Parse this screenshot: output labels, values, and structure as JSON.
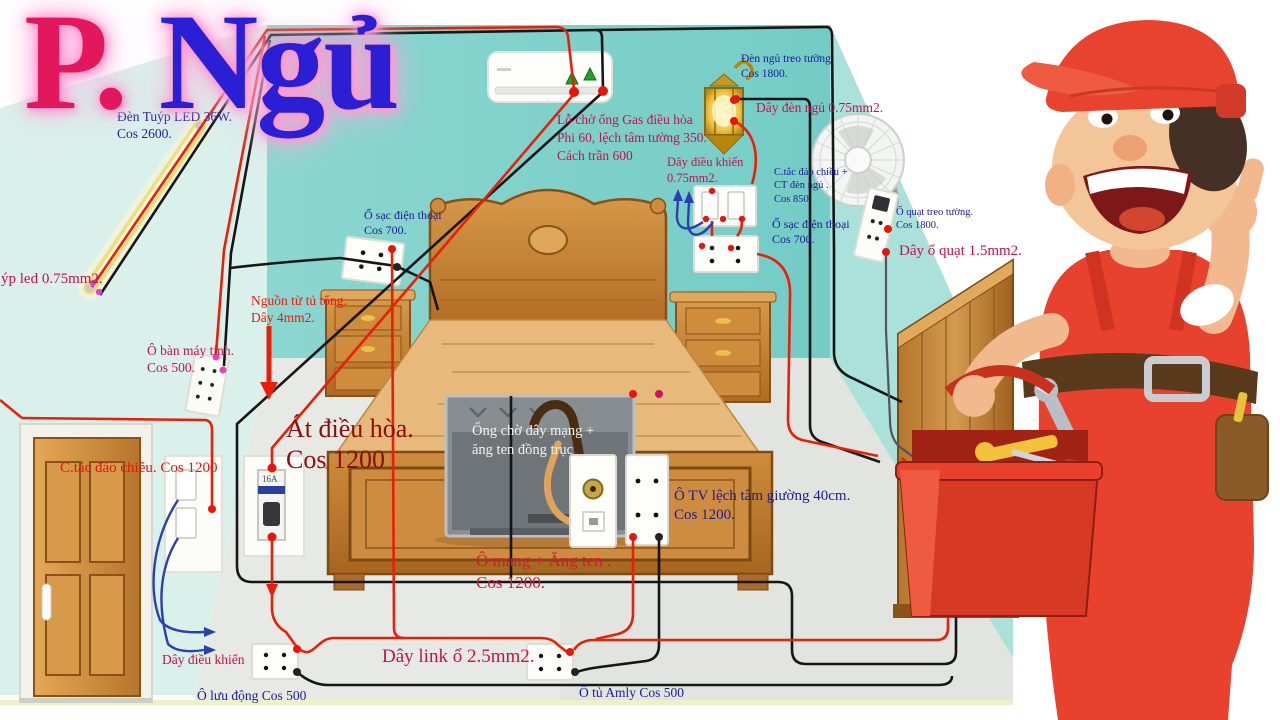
{
  "title": {
    "p": "P.",
    "ngu": " Ngủ"
  },
  "colors": {
    "wire_red": "#e8200a",
    "wire_black": "#161616",
    "wire_blue": "#2b3fae",
    "label_navy": "#1d1c96",
    "label_crimson": "#c9104e",
    "label_red": "#ee1111",
    "label_darkred": "#8e0d0d",
    "wall_back": "#7fd1cb",
    "wall_left": "#daf0ea",
    "wall_right": "#abe1db",
    "floor": "#e7e9e4",
    "title_p": "#e3175c",
    "title_ngu": "#2a1fd4"
  },
  "labels": {
    "led": [
      "Đèn Tuýp LED 36W.",
      "Cos 2600."
    ],
    "led_wire": [
      "ýp led 0.75mm2."
    ],
    "ac_hole": [
      "Lỗ chờ ống Gas điều hòa",
      "Phi 60, lệch tâm tường 350.",
      "Cách trần 600"
    ],
    "lamp": [
      "Đèn ngủ treo tường",
      "Cos 1800."
    ],
    "lamp_wire": [
      "Dây đèn ngủ 0.75mm2."
    ],
    "ctrl_right": [
      "Dây điều khiển",
      "0.75mm2."
    ],
    "switch_right": [
      "C.tắc đảo chiều +",
      "CT đèn ngủ .",
      "Cos 850."
    ],
    "phone_right": [
      "Ổ sạc điện thoại",
      "Cos 700."
    ],
    "fan_outlet": [
      "Ổ quạt treo tường.",
      "Cos 1800."
    ],
    "fan_wire": [
      "Dây ổ quạt 1.5mm2."
    ],
    "phone_left": [
      "Ổ sạc điện thoại",
      "Cos 700."
    ],
    "source": [
      "Nguồn từ tủ tổng.",
      "Dây 4mm2."
    ],
    "computer": [
      "Ô bàn máy tính.",
      "Cos 500."
    ],
    "breaker": [
      "Át điều hòa.",
      "Cos 1200"
    ],
    "breaker_amp": "16A",
    "tv_conduit": [
      "Ống chờ dây mạng +",
      "ăng ten đồng trục"
    ],
    "network": [
      "Ô mạng + Ăng ten .",
      "Cos 1200."
    ],
    "tv_outlet": [
      "Ô TV lệch tâm giường 40cm.",
      "Cos 1200."
    ],
    "door_switch": [
      "C.tắc đảo chiều. Cos 1200"
    ],
    "ctrl_left": [
      "Dây điều khiển"
    ],
    "mobile": [
      "Ô lưu động Cos 500"
    ],
    "link_wire": [
      "Dây link ổ 2.5mm2."
    ],
    "amly": [
      "Ổ tủ Amly Cos 500"
    ]
  }
}
